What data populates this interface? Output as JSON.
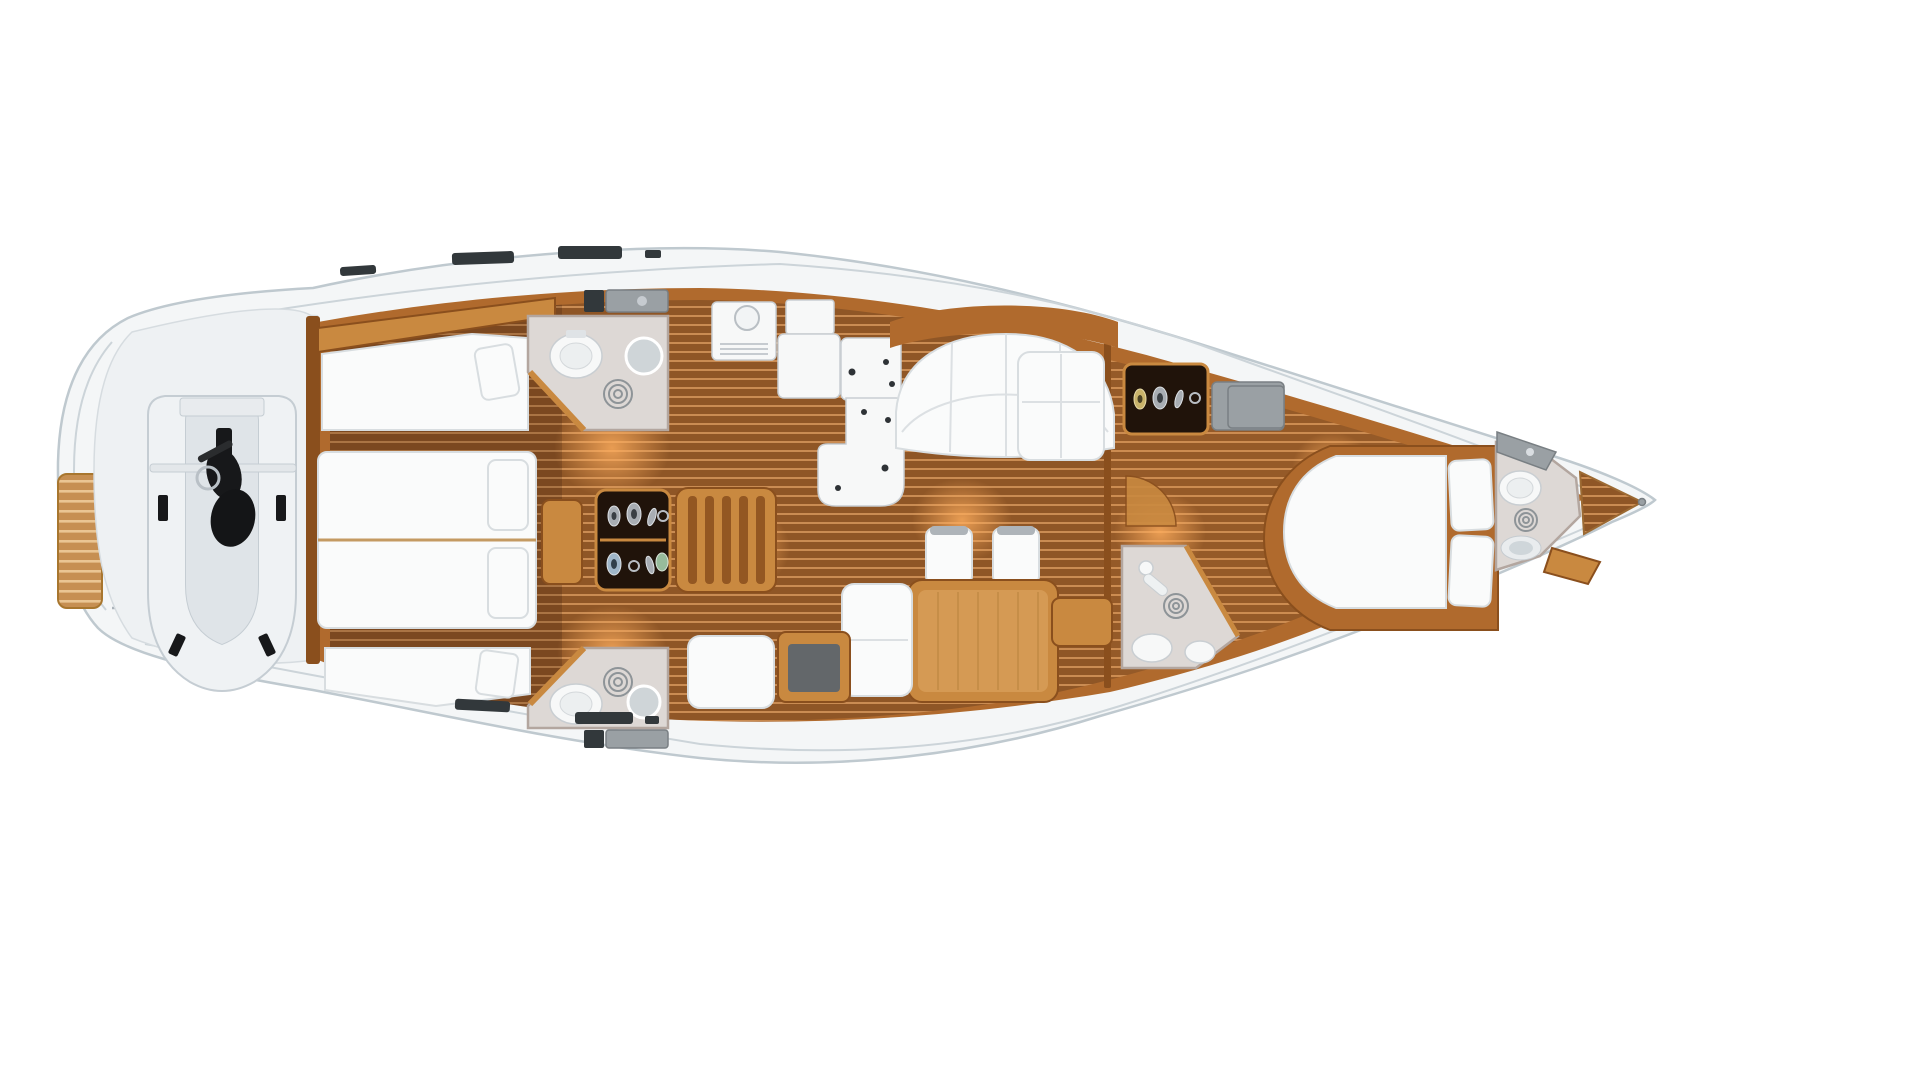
{
  "image": {
    "type": "floorplan-rendering",
    "subject": "Sailing yacht interior deck layout, top view 3D rendering",
    "background": "#ffffff"
  },
  "colors": {
    "hull": "#f4f6f7",
    "hull_outline": "#bfc9cf",
    "deck_seam": "#ccd4d9",
    "wood": "#b06a2d",
    "wood_dark": "#8a4f1d",
    "wood_light": "#c98940",
    "teak_base": "#8f5626",
    "teak_stripe": "#d89a5e",
    "mattress": "#fafbfb",
    "mattress_edge": "#d8dde0",
    "fixture_white": "#f7f8f8",
    "bathroom_floor": "#ddd8d5",
    "bathroom_wall": "#b3a69f",
    "cabinet_dark": "#20130a",
    "counter_gray": "#9aa0a4",
    "hatch_dark": "#32383b",
    "motor_black": "#17181a",
    "glow": "#ffae5e"
  },
  "regions": [
    {
      "id": "swim-platform",
      "label": "Stern swim platform with teak steps"
    },
    {
      "id": "tender-garage",
      "label": "Transom garage stowing inflatable dinghy with outboard engine"
    },
    {
      "id": "aft-cabin",
      "label": "Aft cabin with twin berths and two hull-side single berths"
    },
    {
      "id": "aft-head-port",
      "label": "Aft heads: toilet, washbasin, shower drain, vanity counter"
    },
    {
      "id": "aft-head-starboard",
      "label": "Mirrored aft heads: toilet, washbasin, shower drain"
    },
    {
      "id": "companionway",
      "label": "Companionway stairs beside display locker with metal objects"
    },
    {
      "id": "galley",
      "label": "Galley: refrigerator, worktops with sinks, island unit"
    },
    {
      "id": "saloon",
      "label": "Saloon: curved settee, dining table, two chairs, chaise, chart desk"
    },
    {
      "id": "nav-area",
      "label": "Navigation corner: white cabinet, display locker, grey chart locker"
    },
    {
      "id": "owner-cabin",
      "label": "Owner's cabin with island double berth and two pillows"
    },
    {
      "id": "owner-head",
      "label": "Owner's shower room with shower head and drain"
    },
    {
      "id": "forward-head",
      "label": "Forepeak heads: vanity, toilet, shower drain, washbasin"
    },
    {
      "id": "bow-deck",
      "label": "Bow tip with teak anchor-locker deck"
    }
  ]
}
